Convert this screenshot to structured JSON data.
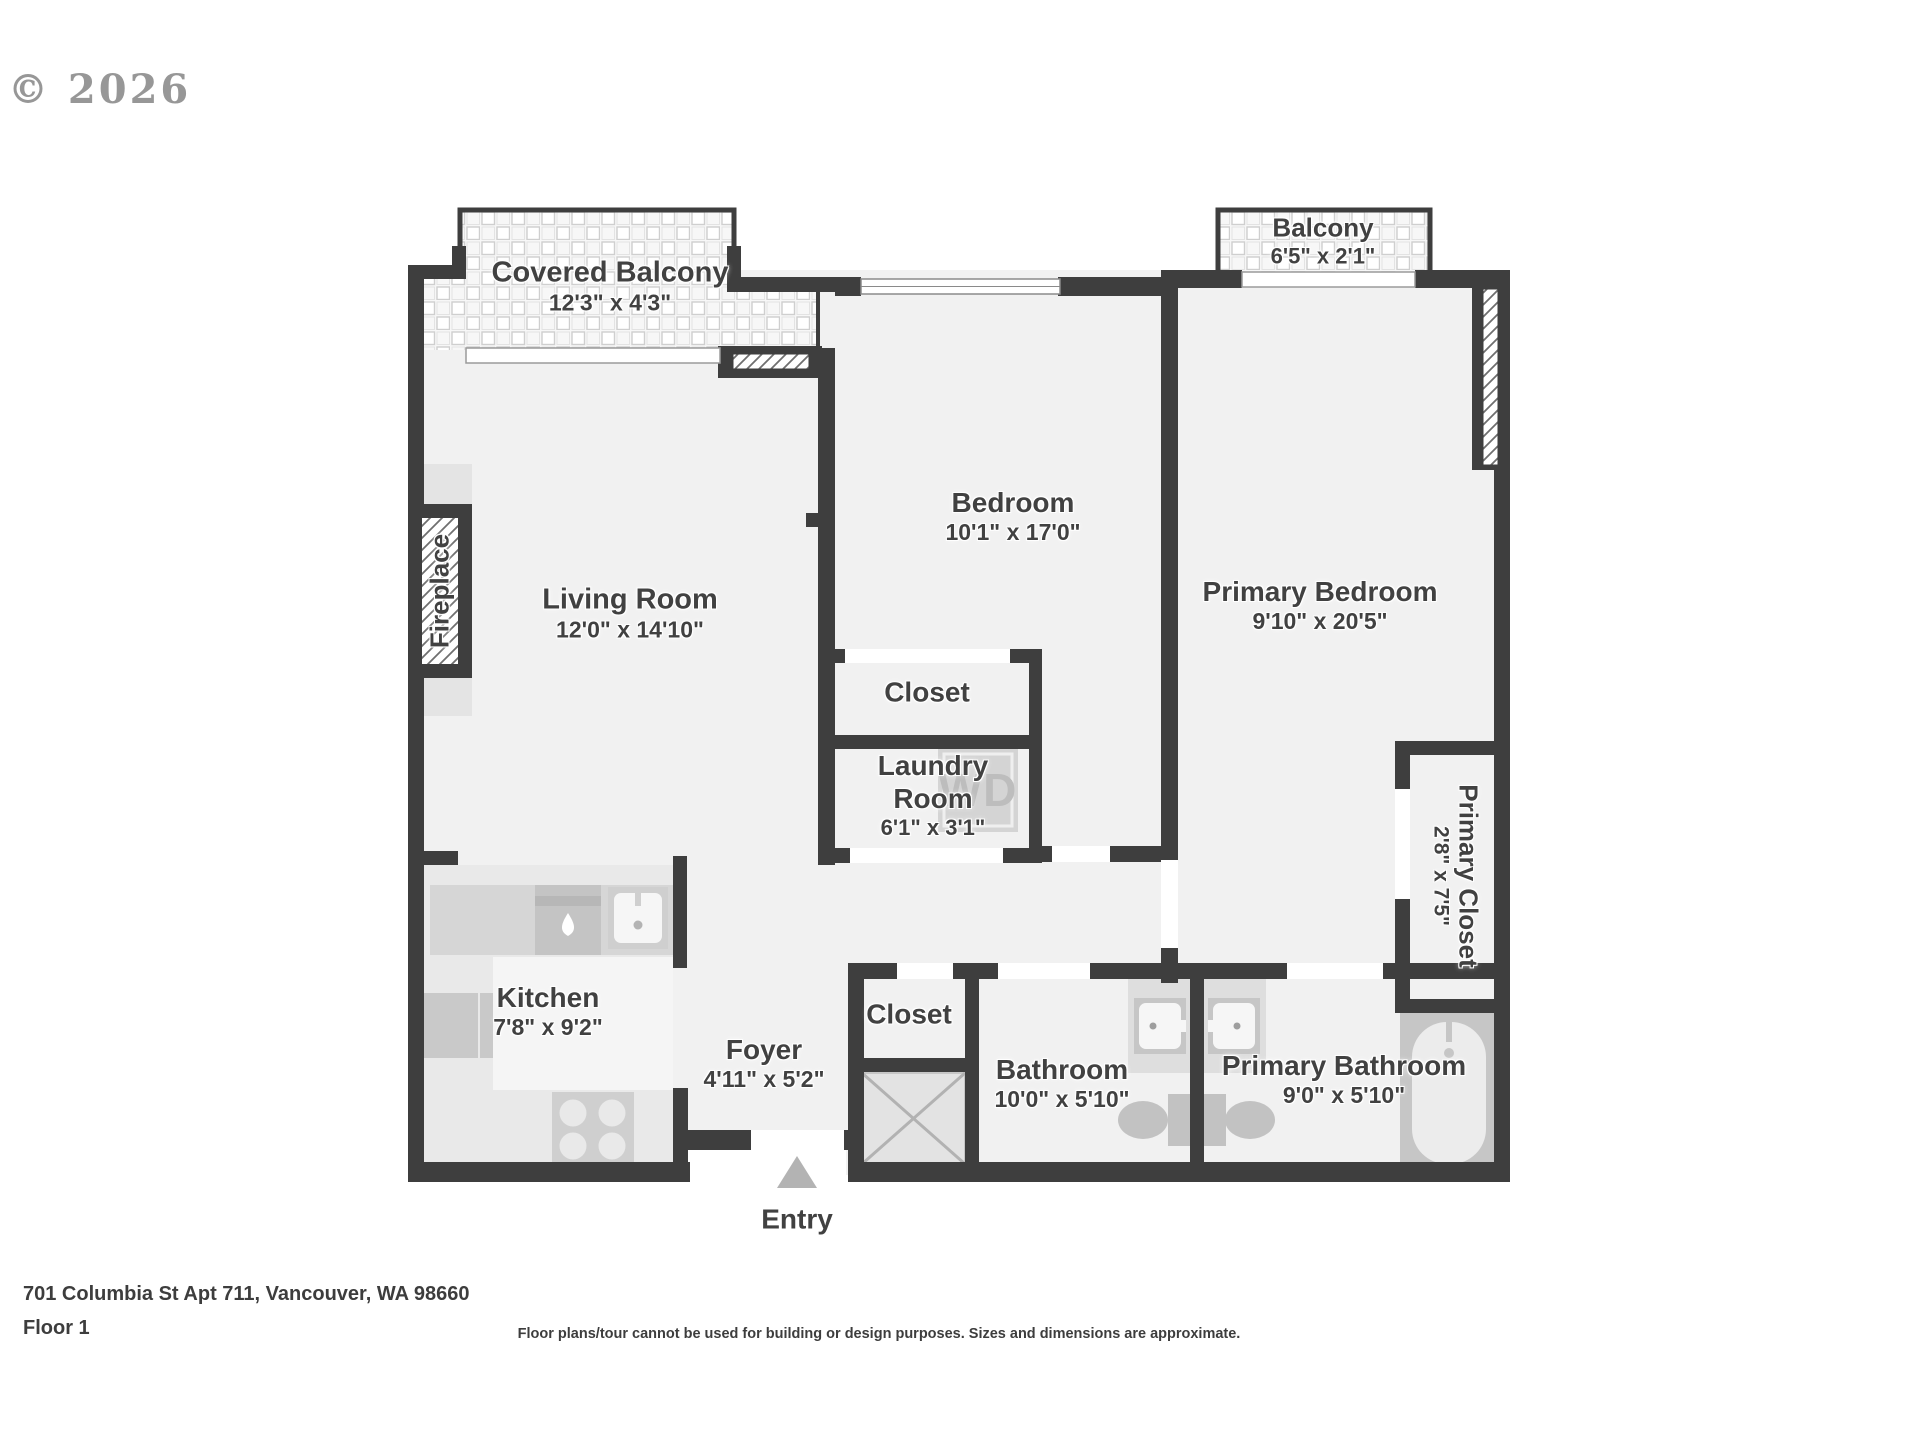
{
  "watermark": {
    "copyright": "© 2026"
  },
  "plan": {
    "rooms": {
      "covered_balcony": {
        "name": "Covered Balcony",
        "dims": "12'3\" x 4'3\""
      },
      "balcony": {
        "name": "Balcony",
        "dims": "6'5\" x 2'1\""
      },
      "living_room": {
        "name": "Living Room",
        "dims": "12'0\" x 14'10\""
      },
      "bedroom": {
        "name": "Bedroom",
        "dims": "10'1\" x 17'0\""
      },
      "primary_bedroom": {
        "name": "Primary Bedroom",
        "dims": "9'10\" x 20'5\""
      },
      "closet": {
        "name": "Closet"
      },
      "laundry_room": {
        "name": "Laundry Room",
        "dims": "6'1\" x 3'1\""
      },
      "primary_closet": {
        "name": "Primary Closet",
        "dims": "2'8\" x 7'5\""
      },
      "kitchen": {
        "name": "Kitchen",
        "dims": "7'8\" x 9'2\""
      },
      "foyer": {
        "name": "Foyer",
        "dims": "4'11\" x 5'2\""
      },
      "closet_2": {
        "name": "Closet"
      },
      "bathroom": {
        "name": "Bathroom",
        "dims": "10'0\" x 5'10\""
      },
      "primary_bathroom": {
        "name": "Primary Bathroom",
        "dims": "9'0\" x 5'10\""
      },
      "fireplace": {
        "name": "Fireplace"
      }
    },
    "entry_label": "Entry",
    "washer_dryer_label": "WD"
  },
  "footer": {
    "address": "701 Columbia St Apt 711, Vancouver, WA 98660",
    "floor": "Floor 1",
    "disclaimer": "Floor plans/tour cannot be used for building or design purposes. Sizes and dimensions are approximate."
  },
  "colors": {
    "wall": "#3e3e3e",
    "floor": "#f1f1f1",
    "fixture_gray": "#c9c9c9",
    "label_text": "#414141"
  }
}
